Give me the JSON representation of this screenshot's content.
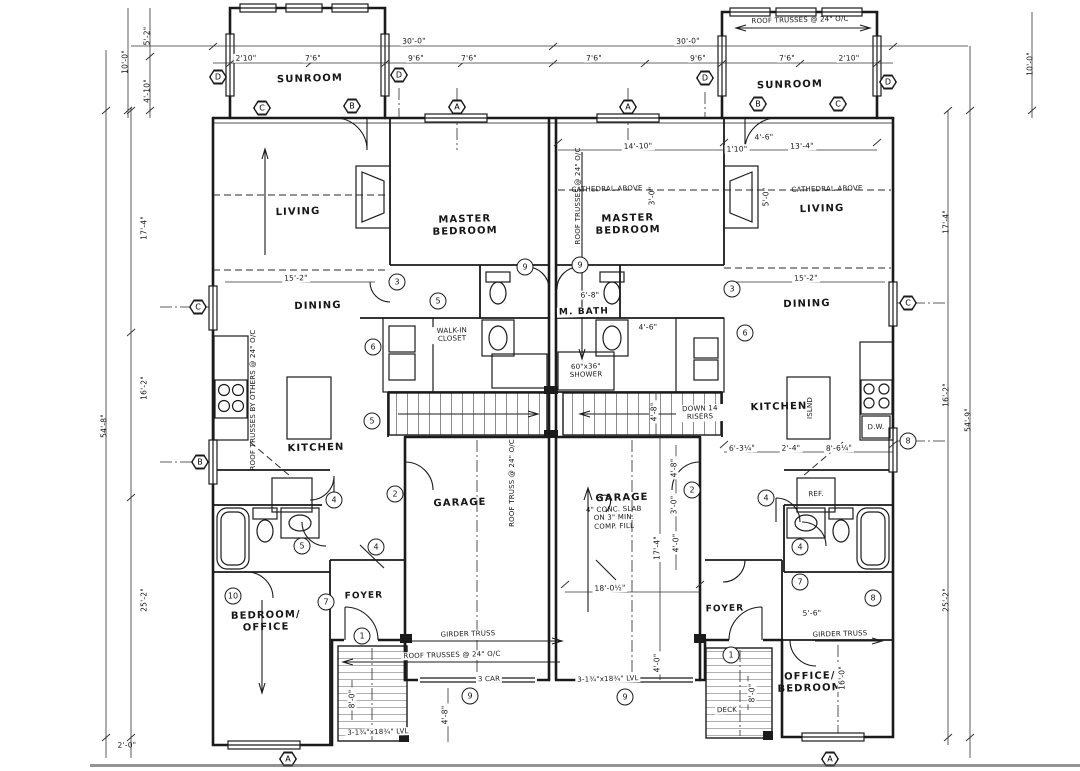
{
  "document": {
    "kind": "Hand-drawn duplex first-floor plan (scanned architectural sketch)",
    "paper_color": "#ffffff",
    "ink_color": "#1b1b1b"
  },
  "rooms": {
    "sunroom": "SUNROOM",
    "living": "LIVING",
    "master": "MASTER BEDROOM",
    "dining": "DINING",
    "kitchen": "KITCHEN",
    "m_bath": "M. BATH",
    "wic": "WALK-IN CLOSET",
    "garage": "GARAGE",
    "foyer": "FOYER",
    "bedroom_office": "BEDROOM/ OFFICE",
    "office_bedroom": "OFFICE/ BEDROOM",
    "deck": "DECK"
  },
  "notes": {
    "roof_trusses": "ROOF TRUSSES @ 24\" O/C",
    "roof_truss_garage": "ROOF TRUSS @ 24\" O/C",
    "roof_trusses_by_others": "ROOF TRUSSES BY OTHERS @ 24\" O/C",
    "girder": "GIRDER TRUSS",
    "cathedral": "CATHEDRAL ABOVE",
    "down_risers": "DOWN 14 RISERS",
    "slab": "4\" CONC. SLAB ON 3\" MIN. COMP. FILL",
    "shower": "60\"x36\" SHOWER",
    "lvl": "3-1¾\"x18¾\" LVL",
    "car": "3 CAR",
    "dw": "D.W.",
    "ref": "REF.",
    "island": "ISLND"
  },
  "dims": {
    "w30": "30'-0\"",
    "w2_10": "2'10\"",
    "w7_6": "7'6\"",
    "w9_6": "9'6\"",
    "h5_2": "5'-2\"",
    "h4_10": "4'-10\"",
    "h10_0": "10'-0\"",
    "h17_4": "17'-4\"",
    "h16_2": "16'-2\"",
    "h54_8": "54'-8\"",
    "h54_9": "54'-9\"",
    "h25_2": "25'-2\"",
    "h2_0": "2'-0\"",
    "d14_10": "14'-10\"",
    "d13_4": "13'-4\"",
    "d15_2": "15'-2\"",
    "d6_8": "6'-8\"",
    "d4_6": "4'-6\"",
    "d1_10": "1'10\"",
    "d5_0": "5'-0\"",
    "d3_0": "3'-0\"",
    "g18": "18'-0½\"",
    "g4_8": "4'-8\"",
    "g4_0": "4'-0\"",
    "k6_3": "6'-3¼\"",
    "k2_4": "2'-4\"",
    "k8_6": "8'-6¼\"",
    "b8_0": "8'-0\"",
    "b5_6": "5'-6\"",
    "b16_0": "16'-0\""
  },
  "markers": {
    "a": "A",
    "b": "B",
    "c": "C",
    "d": "D",
    "n1": "1",
    "n2": "2",
    "n3": "3",
    "n4": "4",
    "n5": "5",
    "n6": "6",
    "n7": "7",
    "n8": "8",
    "n9": "9",
    "n10": "10"
  }
}
